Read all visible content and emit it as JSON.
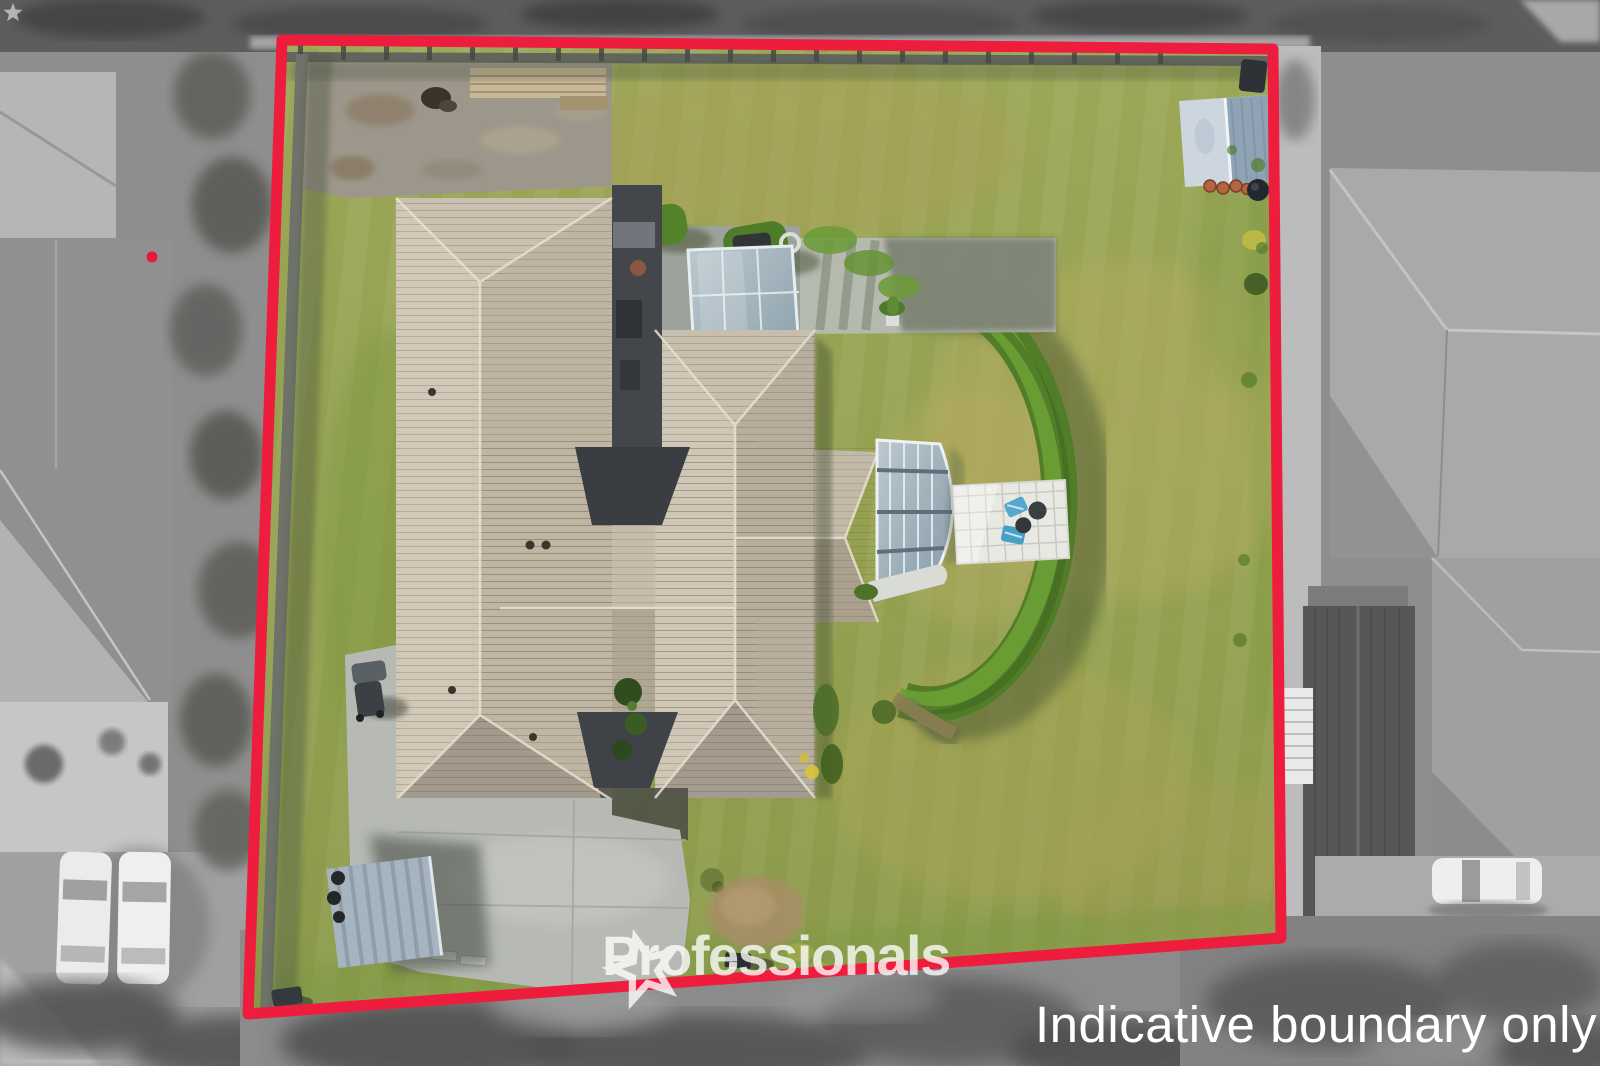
{
  "photo": {
    "kind": "aerial-drone-photo",
    "subject": "residential property with house, lawn, curved hedge, driveway, shed and patios",
    "width_px": 1600,
    "height_px": 1066,
    "surroundings_style": "desaturated grayscale outside boundary, full color inside"
  },
  "watermarks": {
    "brand": "Professionals",
    "disclaimer": "Indicative boundary only"
  },
  "boundary": {
    "style": "solid red indicative boundary outline",
    "color": "#ee1c3d",
    "corners_px": [
      [
        282,
        40
      ],
      [
        1273,
        49
      ],
      [
        1281,
        938
      ],
      [
        248,
        1014
      ]
    ]
  },
  "palette": {
    "boundary_red": "#ee1c3d",
    "watermark_white": "#ffffff",
    "lawn_green": "#96a351",
    "dry_grass": "#b2a95e",
    "hedge_green": "#55832c",
    "roof_tile_tan": "#c7bdac",
    "roof_dark_accent": "#3e4246",
    "concrete_gray": "#b7bab4",
    "gravel_gray": "#9d968a",
    "conservatory_glass": "#aabfc9",
    "shed_roof_blue_gray": "#8fa3b4",
    "terracotta_pot": "#b4643f"
  }
}
